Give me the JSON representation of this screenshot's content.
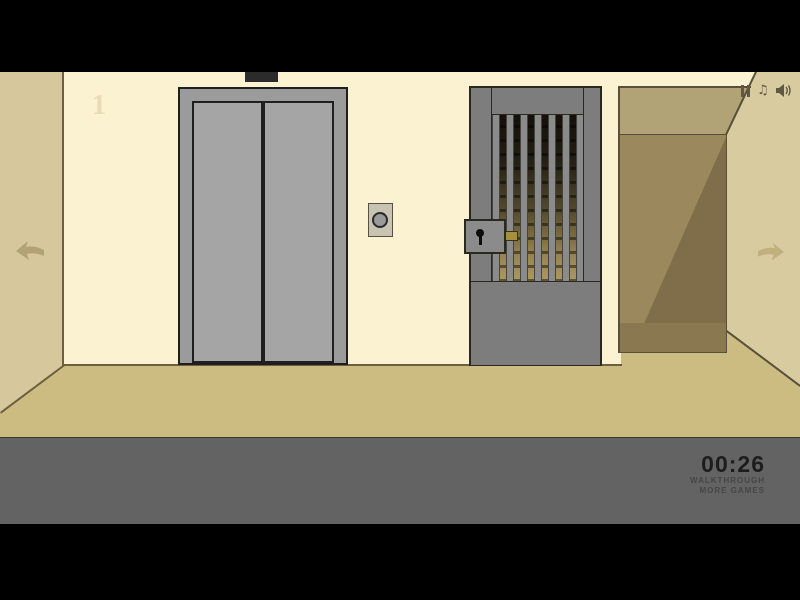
{
  "scene": {
    "floor_label": "1",
    "gate": {
      "bar_count": 7
    }
  },
  "icons": {
    "music_glyph": "♫",
    "names": [
      "pause-icon",
      "music-note-icon",
      "speaker-icon",
      "left-arrow-icon",
      "right-arrow-icon",
      "keyhole-icon"
    ]
  },
  "hud": {
    "timer": "00:26",
    "links": [
      {
        "label": "WALKTHROUGH"
      },
      {
        "label": "MORE GAMES"
      }
    ]
  },
  "colors": {
    "wall": "#faf2d0",
    "sidewall": "#d6c89c",
    "rightwall": "#d9cba0",
    "band": "#b2a377",
    "recess": "#9b895d",
    "recessdark": "#7f6e49",
    "corrfloor": "#8a7850",
    "floor": "#cdbc82",
    "edge": "#6b6040",
    "edge2": "#57503a",
    "metal": "#9b9b9b",
    "door": "#a5a5a5",
    "outline": "#1f1f1f",
    "gate": "#7d7d7d",
    "gateoutline": "#2a291f",
    "bar": "#8b8b8b",
    "lockbox": "#8b8b8b",
    "gold": "#a78e41",
    "panelbg": "#c9c3b2",
    "hudbar": "#636363",
    "timercol": "#1d1d1d",
    "linkcol": "#464646",
    "icon": "#5f5843",
    "arrow": "#b2a274",
    "arrowright": "#c1b07e",
    "label1": "#e9dbb3",
    "indicator": "#2b2b2b",
    "btncircle": "#9a9a9a"
  }
}
